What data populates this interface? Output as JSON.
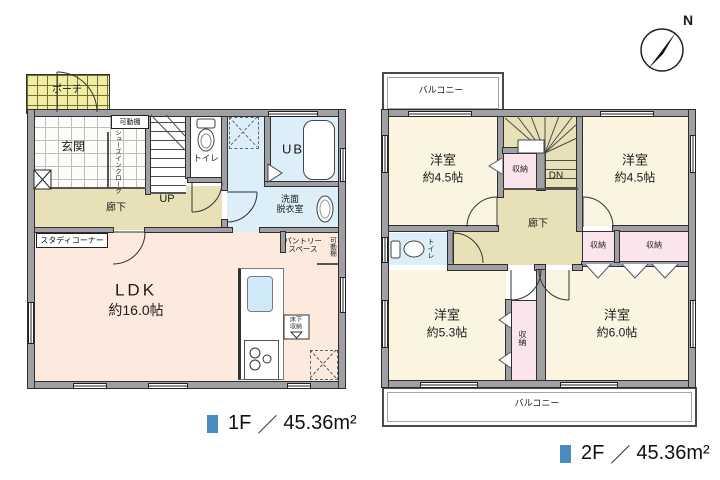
{
  "colors": {
    "legend_marker": "#4a8cbe",
    "wall": "#9f9fa4",
    "ldk_fill": "#fceade",
    "western_room_fill": "#faf4e1",
    "hallway_fill": "#e8e1b8",
    "closet_fill": "#fbe5ec",
    "wet_area_fill": "#dceef8",
    "porch_fill": "#f2eda0"
  },
  "compass": {
    "north": "N"
  },
  "floor1": {
    "porch": "ポーチ",
    "entrance": "玄関",
    "shelf": "可動棚",
    "shoe_closet": "シューズインクローク",
    "stairs": "UP",
    "toilet": "トイレ",
    "bath": "UB",
    "washroom_l1": "洗面",
    "washroom_l2": "脱衣室",
    "hallway": "廊下",
    "study": "スタディコーナー",
    "ldk": "LDK",
    "ldk_size": "約16.0帖",
    "pantry_l1": "パントリー",
    "pantry_l2": "スペース",
    "pantry_shelf": "可動棚",
    "floor_storage_l1": "床下",
    "floor_storage_l2": "収納",
    "legend": {
      "floor": "1F",
      "slash": "／",
      "area": "45.36m²"
    }
  },
  "floor2": {
    "balcony_top": "バルコニー",
    "balcony_bottom": "バルコニー",
    "room_nw": "洋室",
    "room_nw_size": "約4.5帖",
    "room_ne": "洋室",
    "room_ne_size": "約4.5帖",
    "room_sw": "洋室",
    "room_sw_size": "約5.3帖",
    "room_se": "洋室",
    "room_se_size": "約6.0帖",
    "stairs": "DN",
    "hallway": "廊下",
    "toilet": "トイレ",
    "closet_stairs": "収納",
    "closet_small": "収納",
    "closet_wide": "収納",
    "closet_mid": "収納",
    "legend": {
      "floor": "2F",
      "slash": "／",
      "area": "45.36m²"
    }
  }
}
